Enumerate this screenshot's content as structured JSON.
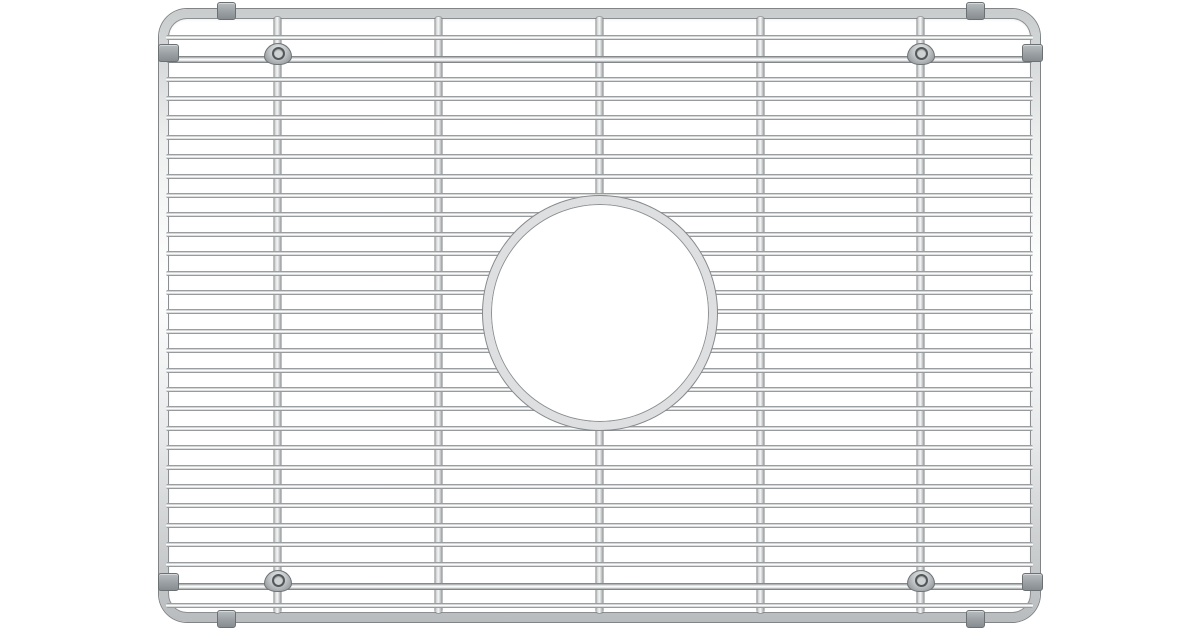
{
  "scene": {
    "description": "Stainless steel wire sink grid (sink protector rack) with rounded-corner tube frame, circular drain cutout ring, four dome feet and gray protective edge bumpers, photographed top-down on a plain white background",
    "background_color": "#ffffff"
  },
  "palette": {
    "wire_dark": "#7d8082",
    "wire_mid": "#c6c9ca",
    "wire_light": "#ffffff",
    "frame_outline": "#808486",
    "ring_fill": "#dedfe0",
    "ring_outline": "#85898b",
    "bumper_fill": "#9aa0a4",
    "bumper_outline": "#6b7073",
    "foot_fill": "#b7bbbe",
    "foot_hole": "#53585a"
  },
  "grid": {
    "canvas": {
      "width": 1200,
      "height": 630
    },
    "frame": {
      "x": 159,
      "y": 9,
      "width": 881,
      "height": 613,
      "tube_thickness": 10,
      "corner_radius": 28
    },
    "horizontal_wires": {
      "x_start": 166,
      "x_end": 1033,
      "thickness": 5,
      "y_positions": [
        37,
        79,
        98.4,
        117.8,
        137.2,
        156.6,
        176,
        195.4,
        214.8,
        234.2,
        253.6,
        273,
        292.4,
        311.8,
        331.2,
        350.6,
        370,
        389.4,
        408.8,
        428.2,
        447.6,
        467,
        486.4,
        505.8,
        525.2,
        544.6,
        564,
        605
      ]
    },
    "support_rails": {
      "x_start": 166,
      "x_end": 1033,
      "thickness": 7,
      "y_positions": [
        59,
        586
      ]
    },
    "vertical_wires": {
      "y_start": 17,
      "y_end": 613,
      "width": 7,
      "x_positions": [
        277,
        438,
        599,
        760,
        920
      ]
    },
    "drain_hole": {
      "cx": 600,
      "cy": 313,
      "outer_radius": 117,
      "ring_thickness": 8
    },
    "feet": [
      {
        "cx": 277,
        "rail_y": 59
      },
      {
        "cx": 920,
        "rail_y": 59
      },
      {
        "cx": 277,
        "rail_y": 586
      },
      {
        "cx": 920,
        "rail_y": 586
      }
    ],
    "bumpers": [
      {
        "side": "top",
        "cx": 225,
        "cy": 10
      },
      {
        "side": "top",
        "cx": 974,
        "cy": 10
      },
      {
        "side": "bottom",
        "cx": 225,
        "cy": 618
      },
      {
        "side": "bottom",
        "cx": 974,
        "cy": 618
      },
      {
        "side": "left",
        "cx": 167,
        "cy": 52
      },
      {
        "side": "left",
        "cx": 167,
        "cy": 581
      },
      {
        "side": "right",
        "cx": 1031,
        "cy": 52
      },
      {
        "side": "right",
        "cx": 1031,
        "cy": 581
      }
    ]
  }
}
